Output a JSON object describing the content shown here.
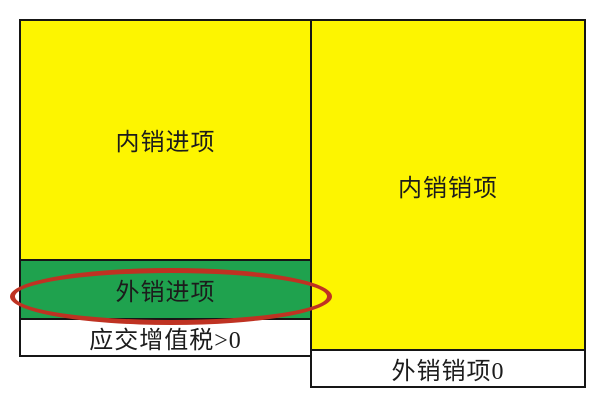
{
  "diagram": {
    "title_semantic": "VAT input/output comparison diagram",
    "left_box": {
      "domestic_input_label": "内销进项",
      "export_input_label": "外销进项",
      "vat_payable_label": "应交增值税>0"
    },
    "right_box": {
      "domestic_output_label": "内销销项",
      "export_output_label": "外销销项0"
    }
  },
  "colors": {
    "background": "#ffffff",
    "yellow": "#fdf500",
    "green": "#1fa24e",
    "white": "#ffffff",
    "border": "#161616",
    "text": "#1c1c1c",
    "ellipse_red": "#bf3222"
  }
}
